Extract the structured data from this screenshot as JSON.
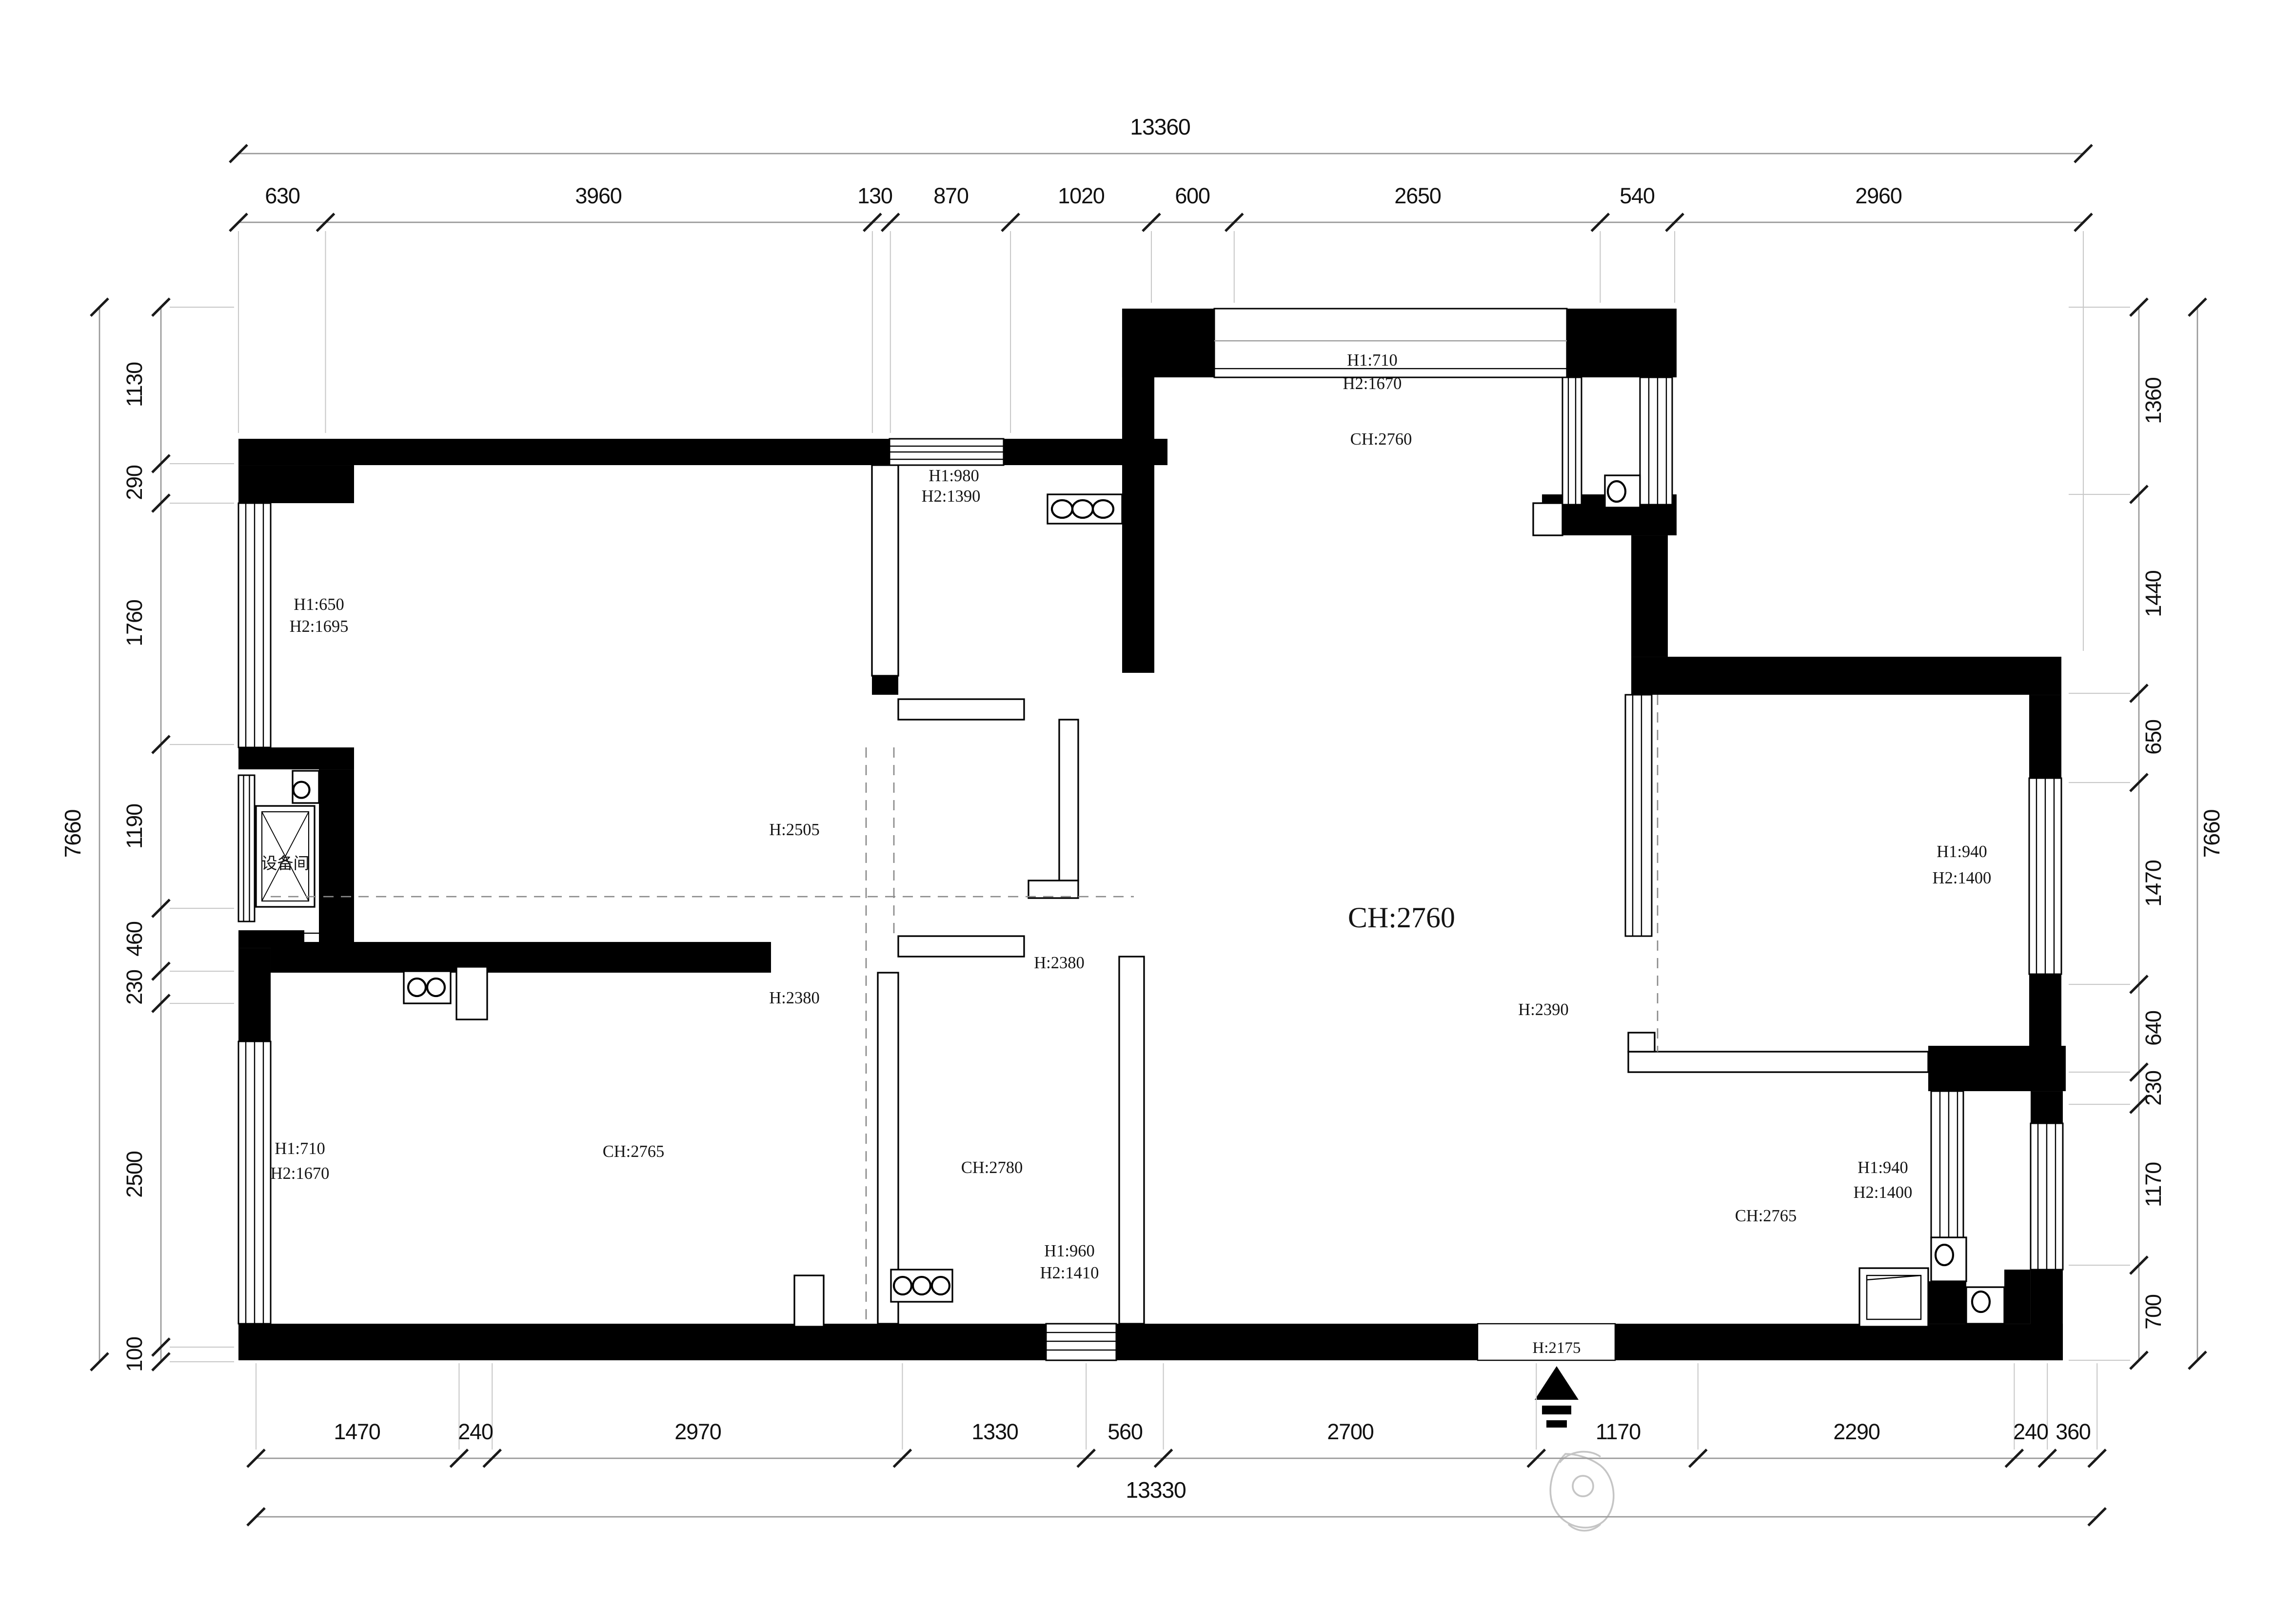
{
  "meta": {
    "drawing_type": "residential floor plan",
    "units": "mm"
  },
  "colors": {
    "wall": "#000000",
    "paper": "#ffffff",
    "dim_line": "#999999",
    "dim_tick": "#1a1a1a",
    "dim_text": "#111111",
    "dashed_line": "#8a8a8a",
    "sketch": "#c5c5c5"
  },
  "dimensions": {
    "top": {
      "total": "13360",
      "segments": [
        "630",
        "3960",
        "130",
        "870",
        "1020",
        "600",
        "2650",
        "540",
        "2960"
      ]
    },
    "bottom": {
      "total": "13330",
      "segments": [
        "1470",
        "240",
        "2970",
        "1330",
        "560",
        "2700",
        "1170",
        "2290",
        "240",
        "360"
      ]
    },
    "left": {
      "total": "7660",
      "segments": [
        "1130",
        "290",
        "1760",
        "1190",
        "460",
        "230",
        "2500",
        "100"
      ]
    },
    "right": {
      "total": "7660",
      "segments": [
        "1360",
        "1440",
        "650",
        "1470",
        "640",
        "230",
        "1170",
        "700"
      ]
    }
  },
  "labels": {
    "balcony_h1": "H1:710",
    "balcony_h2": "H2:1670",
    "balcony_ch": "CH:2760",
    "midroom_h1": "H1:980",
    "midroom_h2": "H2:1390",
    "ul_window_h1": "H1:650",
    "ul_window_h2": "H2:1695",
    "equipment_room": "设备间",
    "ul_zone_h": "H:2505",
    "hall_h": "H:2380",
    "left_zone_h": "H:2380",
    "living_ch": "CH:2760",
    "living_right_h": "H:2390",
    "bl_window_h1": "H1:710",
    "bl_window_h2": "H2:1670",
    "bl_ch": "CH:2765",
    "bath_ch": "CH:2780",
    "bath_h1": "H1:960",
    "bath_h2": "H2:1410",
    "rm_h1": "H1:940",
    "rm_h2": "H2:1400",
    "br_h1": "H1:940",
    "br_h2": "H2:1400",
    "br_ch": "CH:2765",
    "entrance_h": "H:2175"
  },
  "symbols": {
    "entrance_arrow": "entrance-arrow",
    "person": "person-sketch",
    "shaft": "equipment-shaft-x",
    "door_circle": "door-pivot-circle",
    "radiator": "radiator-circles",
    "sink": "sink-basin"
  }
}
